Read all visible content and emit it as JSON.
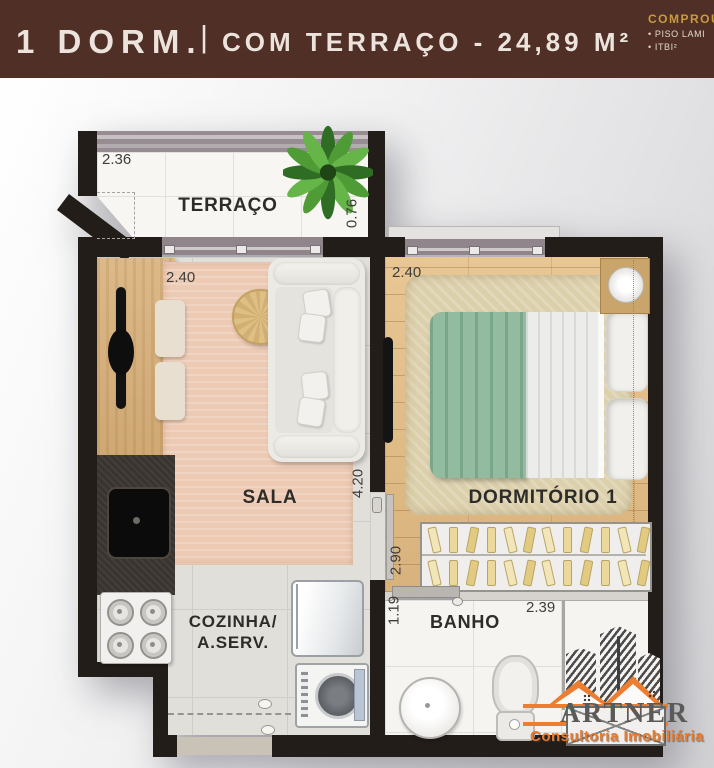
{
  "header": {
    "unit": "1 DORM.",
    "separator": "|",
    "subtitle": "COM TERRAÇO - 24,89 M²",
    "promo": {
      "title": "COMPROU",
      "items": [
        "PISO LAMI",
        "ITBI²"
      ]
    }
  },
  "plan": {
    "rooms": {
      "terraco": "TERRAÇO",
      "sala": "SALA",
      "cozinha_line1": "COZINHA/",
      "cozinha_line2": "A.SERV.",
      "dormitorio": "DORMITÓRIO 1",
      "banho": "BANHO"
    },
    "dims": {
      "terraco_w": "2.36",
      "terraco_d": "0.76",
      "sala_w": "2.40",
      "sala_h": "4.20",
      "dorm_w": "2.40",
      "dorm_h": "2.90",
      "banho_h": "1.19",
      "banho_w": "2.39"
    }
  },
  "logo": {
    "name": "ARTNER",
    "tagline": "Consultoria Imobiliária"
  },
  "colors": {
    "header_bg": "#4f2f26",
    "header_text": "#ece4dc",
    "promo_gold": "#c89b3e",
    "wall": "#231d1a",
    "logo_orange": "#ed7d2f",
    "blanket_green": "#93bb9f",
    "rug_salmon": "#edcab4",
    "wood": "#dfbd8a"
  }
}
